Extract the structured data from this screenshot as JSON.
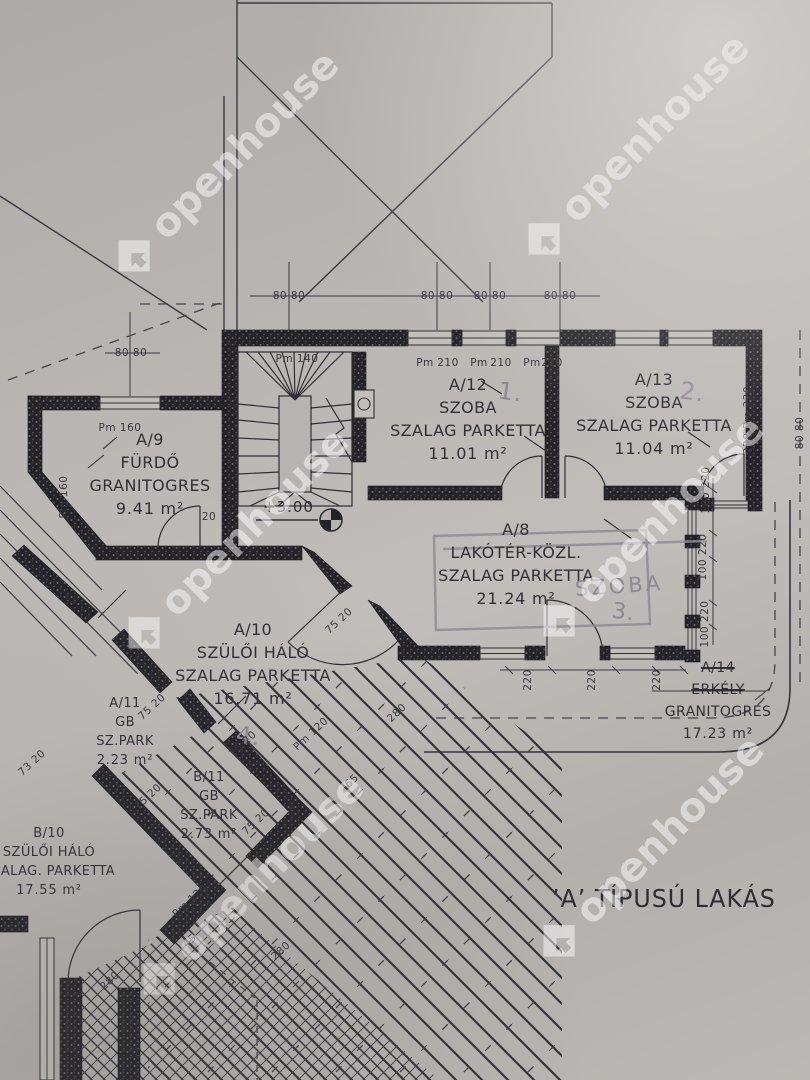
{
  "plan": {
    "title": "’A’ TÍPUSÚ LAKÁS",
    "level_mark": "+3.00"
  },
  "watermark": {
    "text": "openhouse",
    "color": "#ffffff"
  },
  "rooms": {
    "a9": {
      "id": "A/9",
      "name": "FÜRDŐ",
      "finish": "GRANITOGRES",
      "area": "9.41 m²"
    },
    "a12": {
      "id": "A/12",
      "name": "SZOBA",
      "finish": "SZALAG PARKETTA",
      "area": "11.01 m²",
      "note": "1."
    },
    "a13": {
      "id": "A/13",
      "name": "SZOBA",
      "finish": "SZALAG PARKETTA",
      "area": "11.04 m²",
      "note": "2."
    },
    "a8": {
      "id": "A/8",
      "name": "LAKÓTÉR-KÖZL.",
      "finish": "SZALAG PARKETTA",
      "area": "21.24 m²",
      "note": "SZOBA",
      "note2": "3."
    },
    "a10": {
      "id": "A/10",
      "name": "SZÜLŐI HÁLÓ",
      "finish": "SZALAG PARKETTA",
      "area": "16.71 m²",
      "note": "4."
    },
    "a14": {
      "id": "A/14",
      "name": "ERKÉLY",
      "finish": "GRANITOGRES",
      "area": "17.23 m²"
    },
    "a11": {
      "id": "A/11",
      "name": "GB",
      "finish": "SZ.PARK",
      "area": "2.23 m²"
    },
    "b11": {
      "id": "B/11",
      "name": "GB",
      "finish": "SZ.PARK",
      "area": "2.73 m²"
    },
    "b10": {
      "id": "B/10",
      "name": "SZÜLŐI HÁLÓ",
      "finish": "SZALAG. PARKETTA",
      "area": "17.55 m²"
    }
  },
  "dimensions": [
    {
      "text": "Pm 140",
      "x": 297,
      "y": 359
    },
    {
      "text": "Pm",
      "x": 425,
      "y": 363
    },
    {
      "text": "210",
      "x": 448,
      "y": 363
    },
    {
      "text": "Pm",
      "x": 479,
      "y": 363
    },
    {
      "text": "210",
      "x": 501,
      "y": 363
    },
    {
      "text": "Pm",
      "x": 532,
      "y": 363
    },
    {
      "text": "210",
      "x": 552,
      "y": 363
    },
    {
      "text": "80 80",
      "x": 289,
      "y": 296
    },
    {
      "text": "80 80",
      "x": 437,
      "y": 296
    },
    {
      "text": "80 80",
      "x": 490,
      "y": 296
    },
    {
      "text": "80 80",
      "x": 560,
      "y": 296
    },
    {
      "text": "80 80",
      "x": 131,
      "y": 353
    },
    {
      "text": "Pm 160",
      "x": 120,
      "y": 428
    },
    {
      "text": "Pm 160",
      "x": 64,
      "y": 497,
      "rot": -90
    },
    {
      "text": "220 Pm 220",
      "x": 748,
      "y": 420,
      "rot": -90
    },
    {
      "text": "100 220",
      "x": 706,
      "y": 490,
      "rot": -90
    },
    {
      "text": "100 220",
      "x": 703,
      "y": 557,
      "rot": -90
    },
    {
      "text": "100 220",
      "x": 705,
      "y": 624,
      "rot": -90
    },
    {
      "text": "220",
      "x": 528,
      "y": 680,
      "rot": -90
    },
    {
      "text": "220",
      "x": 592,
      "y": 680,
      "rot": -90
    },
    {
      "text": "220",
      "x": 657,
      "y": 680,
      "rot": -90
    },
    {
      "text": "80 80",
      "x": 800,
      "y": 433,
      "rot": -90
    },
    {
      "text": "20",
      "x": 209,
      "y": 517
    },
    {
      "text": "75 20",
      "x": 339,
      "y": 621,
      "rot": -43
    },
    {
      "text": "75 20",
      "x": 152,
      "y": 707,
      "rot": -43
    },
    {
      "text": "75 20",
      "x": 243,
      "y": 744,
      "rot": -43
    },
    {
      "text": "75 20",
      "x": 148,
      "y": 797,
      "rot": -43
    },
    {
      "text": "75 20",
      "x": 256,
      "y": 822,
      "rot": -43
    },
    {
      "text": "73 20",
      "x": 32,
      "y": 763,
      "rot": -43
    },
    {
      "text": "Pm 120",
      "x": 311,
      "y": 734,
      "rot": -43
    },
    {
      "text": "280",
      "x": 397,
      "y": 713,
      "rot": -43
    },
    {
      "text": "65",
      "x": 352,
      "y": 781,
      "rot": -43
    },
    {
      "text": "Pm 120",
      "x": 190,
      "y": 901,
      "rot": -43
    },
    {
      "text": "280",
      "x": 281,
      "y": 951,
      "rot": -43
    },
    {
      "text": "280",
      "x": 110,
      "y": 981,
      "rot": -43
    },
    {
      "text": "45",
      "x": 190,
      "y": 941,
      "rot": -43
    }
  ]
}
